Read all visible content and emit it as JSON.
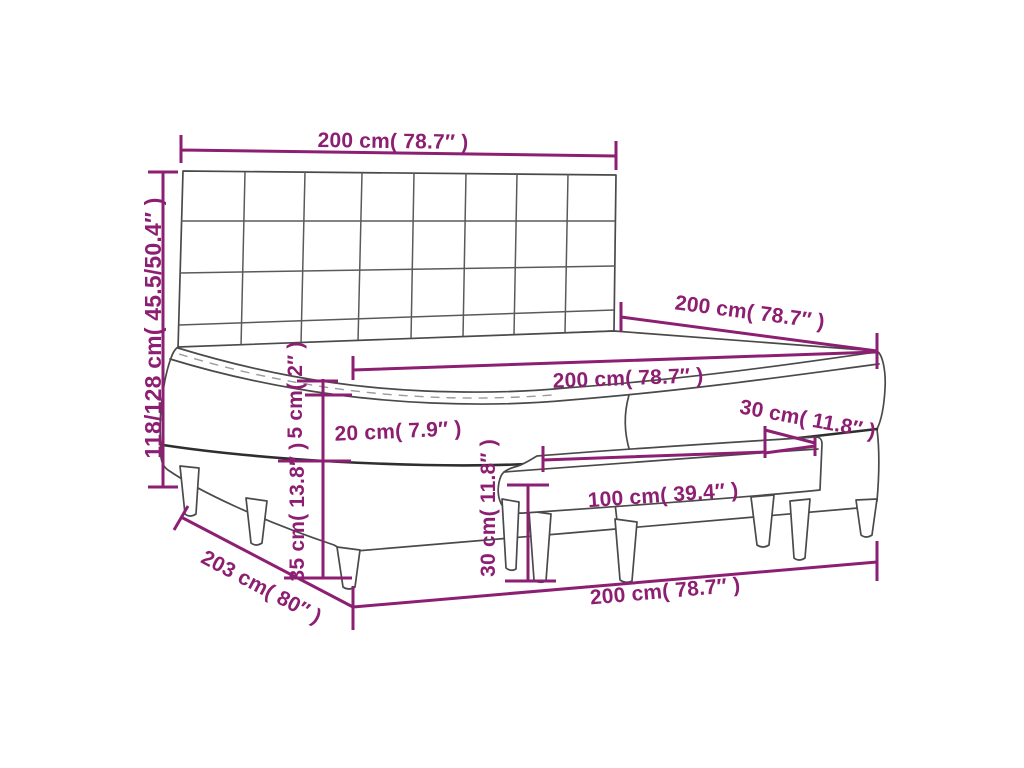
{
  "diagram": {
    "title": "box spring bed with tufted headboard, topper and bench - dimension diagram",
    "accent_color": "#8D1F72",
    "outline_color": "#4A4A4A",
    "labels": {
      "headboard_width": "200 cm( 78.7″ )",
      "overall_height": "118/128 cm( 45.5/50.4″ )",
      "bed_length": "200 cm( 78.7″ )",
      "mattress_width": "200 cm( 78.7″ )",
      "topper_height": "5 cm( 2″ )",
      "mattress_height": "20 cm( 7.9″ )",
      "base_height": "35 cm( 13.8″ )",
      "bench_height": "30 cm( 11.8″ )",
      "bench_width": "100 cm( 39.4″ )",
      "bench_depth": "30 cm( 11.8″ )",
      "floor_diagonal": "203 cm( 80″ )",
      "overall_width": "200 cm( 78.7″ )"
    }
  }
}
